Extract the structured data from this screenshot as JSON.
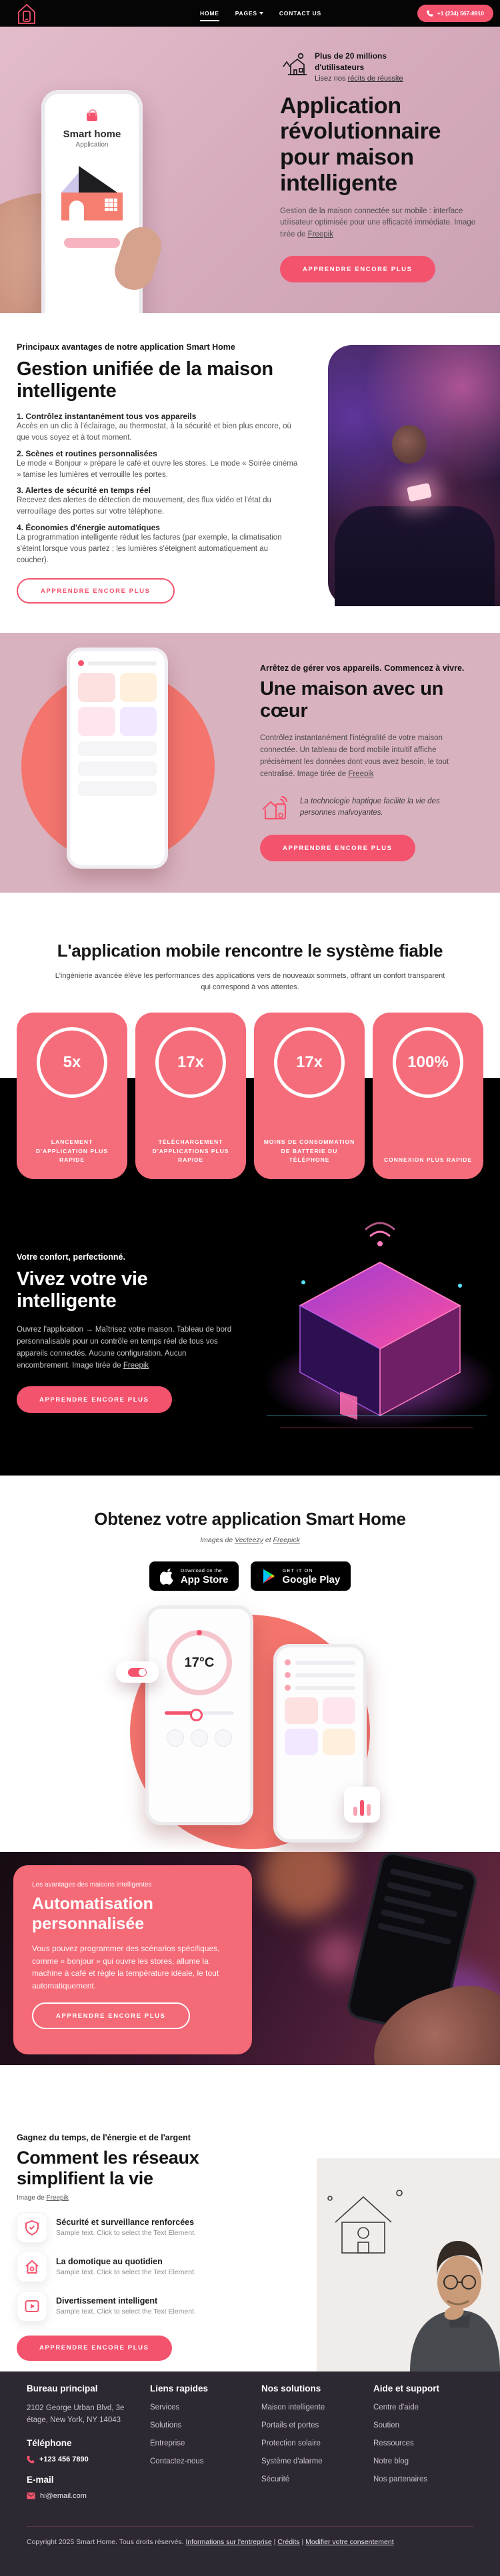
{
  "header": {
    "nav": [
      "HOME",
      "PAGES",
      "CONTACT US"
    ],
    "phone_button": "+1 (234) 567-8910"
  },
  "hero": {
    "badge_title": "Plus de 20 millions d'utilisateurs",
    "badge_link_prefix": "Lisez nos ",
    "badge_link": "récits de réussite",
    "title": "Application révolutionnaire pour maison intelligente",
    "desc": "Gestion de la maison connectée sur mobile : interface utilisateur optimisée pour une efficacité immédiate. Image tirée de ",
    "desc_link": "Freepik",
    "cta": "APPRENDRE ENCORE PLUS",
    "phone_app_name": "Smart home",
    "phone_app_sub": "Application"
  },
  "features": {
    "eyebrow": "Principaux avantages de notre application Smart Home",
    "title": "Gestion unifiée de la maison intelligente",
    "items": [
      {
        "title": "1. Contrôlez instantanément tous vos appareils",
        "text": "Accès en un clic à l'éclairage, au thermostat, à la sécurité et bien plus encore, où que vous soyez et à tout moment."
      },
      {
        "title": "2. Scènes et routines personnalisées",
        "text": "Le mode « Bonjour » prépare le café et ouvre les stores. Le mode « Soirée cinéma » tamise les lumières et verrouille les portes."
      },
      {
        "title": "3. Alertes de sécurité en temps réel",
        "text": "Recevez des alertes de détection de mouvement, des flux vidéo et l'état du verrouillage des portes sur votre téléphone."
      },
      {
        "title": "4. Économies d'énergie automatiques",
        "text": "La programmation intelligente réduit les factures (par exemple, la climatisation s'éteint lorsque vous partez ; les lumières s'éteignent automatiquement au coucher)."
      }
    ],
    "cta": "APPRENDRE ENCORE PLUS"
  },
  "heart": {
    "eyebrow": "Arrêtez de gérer vos appareils. Commencez à vivre.",
    "title": "Une maison avec un cœur",
    "desc": "Contrôlez instantanément l'intégralité de votre maison connectée. Un tableau de bord mobile intuitif affiche précisément les données dont vous avez besoin, le tout centralisé. Image tirée de ",
    "desc_link": "Freepik",
    "note": "La technologie haptique facilite la vie des personnes malvoyantes.",
    "cta": "APPRENDRE ENCORE PLUS"
  },
  "stats": {
    "title": "L'application mobile rencontre le système fiable",
    "subtitle": "L'ingénierie avancée élève les performances des applications vers de nouveaux sommets, offrant un confort transparent qui correspond à vos attentes.",
    "cards": [
      {
        "value": "5x",
        "label": "LANCEMENT D'APPLICATION PLUS RAPIDE"
      },
      {
        "value": "17x",
        "label": "TÉLÉCHARGEMENT D'APPLICATIONS PLUS RAPIDE"
      },
      {
        "value": "17x",
        "label": "MOINS DE CONSOMMATION DE BATTERIE DU TÉLÉPHONE"
      },
      {
        "value": "100%",
        "label": "CONNEXION PLUS RAPIDE"
      }
    ]
  },
  "smartlife": {
    "eyebrow": "Votre confort, perfectionné.",
    "title": "Vivez votre vie intelligente",
    "desc": "Ouvrez l'application → Maîtrisez votre maison. Tableau de bord personnalisable pour un contrôle en temps réel de tous vos appareils connectés. Aucune configuration. Aucun encombrement. Image tirée de ",
    "desc_link": "Freepik",
    "cta": "APPRENDRE ENCORE PLUS"
  },
  "getapp": {
    "title": "Obtenez votre application Smart Home",
    "credit_prefix": "Images de ",
    "credit_link1": "Vecteezy",
    "credit_mid": " et ",
    "credit_link2": "Freepick",
    "appstore_small": "Download on the",
    "appstore_big": "App Store",
    "googleplay_small": "GET IT ON",
    "googleplay_big": "Google Play",
    "thermostat_value": "17°C"
  },
  "automation": {
    "eyebrow": "Les avantages des maisons intelligentes",
    "title": "Automatisation personnalisée",
    "desc": "Vous pouvez programmer des scénarios spécifiques, comme « bonjour » qui ouvre les stores, allume la machine à café et règle la température idéale, le tout automatiquement.",
    "cta": "APPRENDRE ENCORE PLUS"
  },
  "networks": {
    "eyebrow": "Gagnez du temps, de l'énergie et de l'argent",
    "title": "Comment les réseaux simplifient la vie",
    "credit_prefix": "Image de ",
    "credit_link": "Freepik",
    "items": [
      {
        "title": "Sécurité et surveillance renforcées",
        "text": "Sample text. Click to select the Text Element."
      },
      {
        "title": "La domotique au quotidien",
        "text": "Sample text. Click to select the Text Element."
      },
      {
        "title": "Divertissement intelligent",
        "text": "Sample text. Click to select the Text Element."
      }
    ],
    "cta": "APPRENDRE ENCORE PLUS"
  },
  "footer": {
    "col1": {
      "title": "Bureau principal",
      "address": "2102 George Urban Blvd, 3e étage, New York, NY 14043",
      "phone_title": "Téléphone",
      "phone": "+123 456 7890",
      "email_title": "E-mail",
      "email": "hi@email.com"
    },
    "col2": {
      "title": "Liens rapides",
      "links": [
        "Services",
        "Solutions",
        "Entreprise",
        "Contactez-nous"
      ]
    },
    "col3": {
      "title": "Nos solutions",
      "links": [
        "Maison intelligente",
        "Portails et portes",
        "Protection solaire",
        "Système d'alarme",
        "Sécurité"
      ]
    },
    "col4": {
      "title": "Aide et support",
      "links": [
        "Centre d'aide",
        "Soutien",
        "Ressources",
        "Notre blog",
        "Nos partenaires"
      ]
    },
    "copyright": "Copyright 2025 Smart Home. Tous droits réservés. ",
    "sep1": " | ",
    "sep2": " | ",
    "bottom_links": [
      "Informations sur l'entreprise",
      "Crédits",
      "Modifier votre consentement"
    ]
  },
  "icons": {
    "logo": "house-with-phone",
    "header_phone": "phone-receiver",
    "hero_badge": "smart-house-line",
    "heart_note": "house-wifi",
    "appstore": "apple",
    "googleplay": "play-triangle",
    "network_item_icons": [
      "shield-check",
      "smart-home",
      "play-media"
    ],
    "footer_phone": "phone-receiver",
    "footer_email": "envelope"
  },
  "colors": {
    "accent": "#f4536e",
    "stat_card": "#f56d7b",
    "hero_background": "#d9b2bf",
    "coral_circle": "#f4756e",
    "footer_background": "#2e2832"
  }
}
